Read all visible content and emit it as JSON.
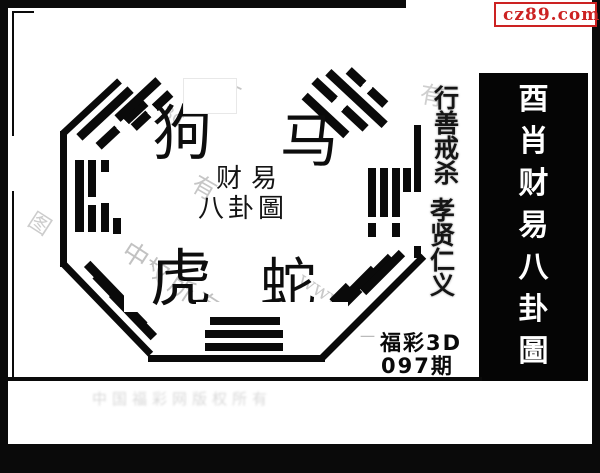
{
  "brand": {
    "site": "cz89.com"
  },
  "colors": {
    "badge_red": "#cc2222",
    "badge_yellow": "#ffee00",
    "ink_black": "#0a0a0a",
    "watermark_gray": "#c6c6c6"
  },
  "right_panel": {
    "title": "酉肖财易八卦圖",
    "chars": [
      "酉",
      "肖",
      "财",
      "易",
      "八",
      "卦",
      "圖"
    ]
  },
  "bagua": {
    "zodiac_top_left": "狗",
    "zodiac_top_right": "马",
    "zodiac_bottom_left": "虎",
    "zodiac_bottom_right": "蛇",
    "seal_line1": "财易",
    "seal_line2": "八卦圖"
  },
  "motto": {
    "col1": "行善戒杀",
    "col1_chars": [
      "行",
      "善",
      "戒",
      "杀"
    ],
    "col2": "孝贤仁义",
    "col2_chars": [
      "孝",
      "贤",
      "仁",
      "义"
    ]
  },
  "issue": {
    "name": "福彩3D",
    "period": "097期"
  },
  "watermarks": {
    "w1": "有",
    "w2": "3g",
    "w3": "有",
    "w4": "中",
    "w5": "权所有",
    "w6": "www.",
    "w7": "图",
    "w8": "有",
    "w9": "一",
    "w10": "中国福彩网版权所有"
  }
}
